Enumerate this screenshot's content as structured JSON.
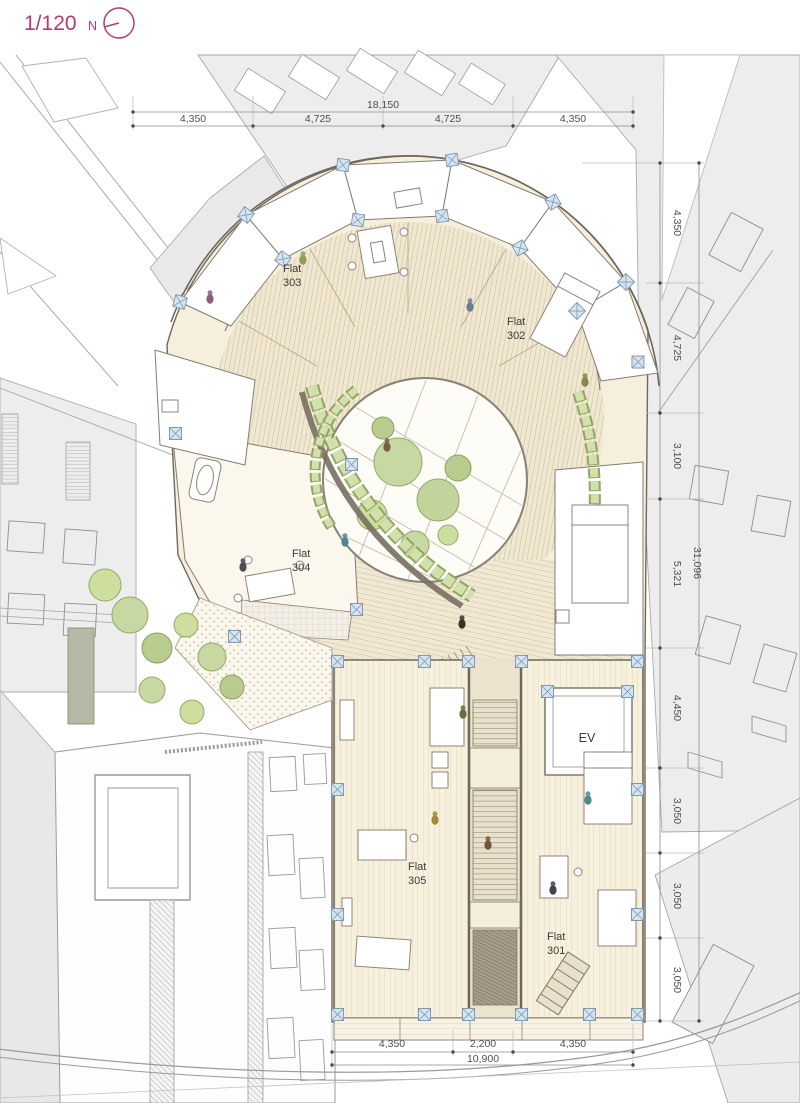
{
  "scale_indicator": {
    "scale": "1/120",
    "north_label": "N"
  },
  "flat_labels": [
    {
      "name": "Flat",
      "number": "303"
    },
    {
      "name": "Flat",
      "number": "302"
    },
    {
      "name": "Flat",
      "number": "304"
    },
    {
      "name": "Flat",
      "number": "305"
    },
    {
      "name": "Flat",
      "number": "301"
    }
  ],
  "elevator_label": "EV",
  "dimensions": {
    "top": {
      "total": "18,150",
      "segments": [
        "4,350",
        "4,725",
        "4,725",
        "4,350"
      ]
    },
    "right": {
      "total": "31,096",
      "segments": [
        "4,350",
        "4,725",
        "3,100",
        "5,321",
        "4,450",
        "3,050",
        "3,050",
        "3,050"
      ]
    },
    "bottom": {
      "total": "10,900",
      "segments": [
        "4,350",
        "2,200",
        "4,350"
      ]
    }
  },
  "colors": {
    "accent_magenta": "#b23a78",
    "dimension_text": "#4f4f4f",
    "floor_cream": "#f6efdd",
    "deck_wood": "#c8b593",
    "column_blue": "#d3e4f2",
    "tree_green": "#c8d8a2",
    "planter_green": "#d2e0ab",
    "background_gray": "#ededed"
  }
}
